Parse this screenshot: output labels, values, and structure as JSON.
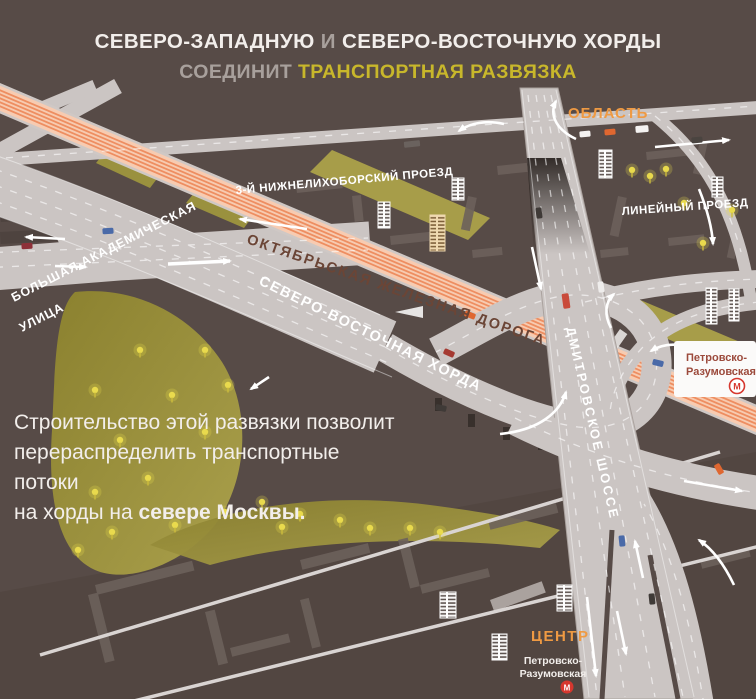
{
  "header": {
    "line1a": "СЕВЕРО-ЗАПАДНУЮ",
    "line1b": "И",
    "line1c": "СЕВЕРО-ВОСТОЧНУЮ ХОРДЫ",
    "line2a": "СОЕДИНИТ",
    "line2b": "ТРАНСПОРТНАЯ РАЗВЯЗКА"
  },
  "labels": {
    "railway": "ОКТЯБРЬСКАЯ ЖЕЛЕЗНАЯ ДОРОГА",
    "svh": "СЕВЕРО-ВОСТОЧНАЯ ХОРДА",
    "dmitrovskoe": "ДМИТРОВСКОЕ ШОССЕ",
    "akadem_line1": "БОЛЬШАЯ АКАДЕМИЧЕСКАЯ",
    "akadem_line2": "УЛИЦА",
    "nizhnelikhoborsky": "3-Й НИЖНЕЛИХОБОРСКИЙ ПРОЕЗД",
    "lineyny": "ЛИНЕЙНЫЙ ПРОЕЗД",
    "oblast": "ОБЛАСТЬ",
    "centr": "ЦЕНТР"
  },
  "metro": {
    "line1": "Петровско-",
    "line2": "Разумовская",
    "m": "М"
  },
  "description": {
    "line1": "Строительство этой развязки позволит",
    "line2": "перераспределить транспортные потоки",
    "line3a": "на хорды на ",
    "line3b": "севере Москвы."
  },
  "colors": {
    "background": "#574b47",
    "road": "#cbc5c3",
    "road_edge": "#aaa29e",
    "railway_base": "#f7cbb1",
    "railway_stripe": "#ee8e61",
    "railway_text": "#6b4536",
    "park1": "#8b812f",
    "park2": "#aaa04c",
    "tree": "#e9da4d",
    "accent_orange": "#ef9a43",
    "accent_yellow": "#c8b72b",
    "metro_red": "#d6372e",
    "text_light": "#f2eeeb",
    "text_gray": "#a8a09c",
    "footprint": "#6c615c",
    "bldg_white": "#f7f5f4",
    "bldg_cream": "#efd9b0",
    "metro_text": "#9c4a3c"
  }
}
